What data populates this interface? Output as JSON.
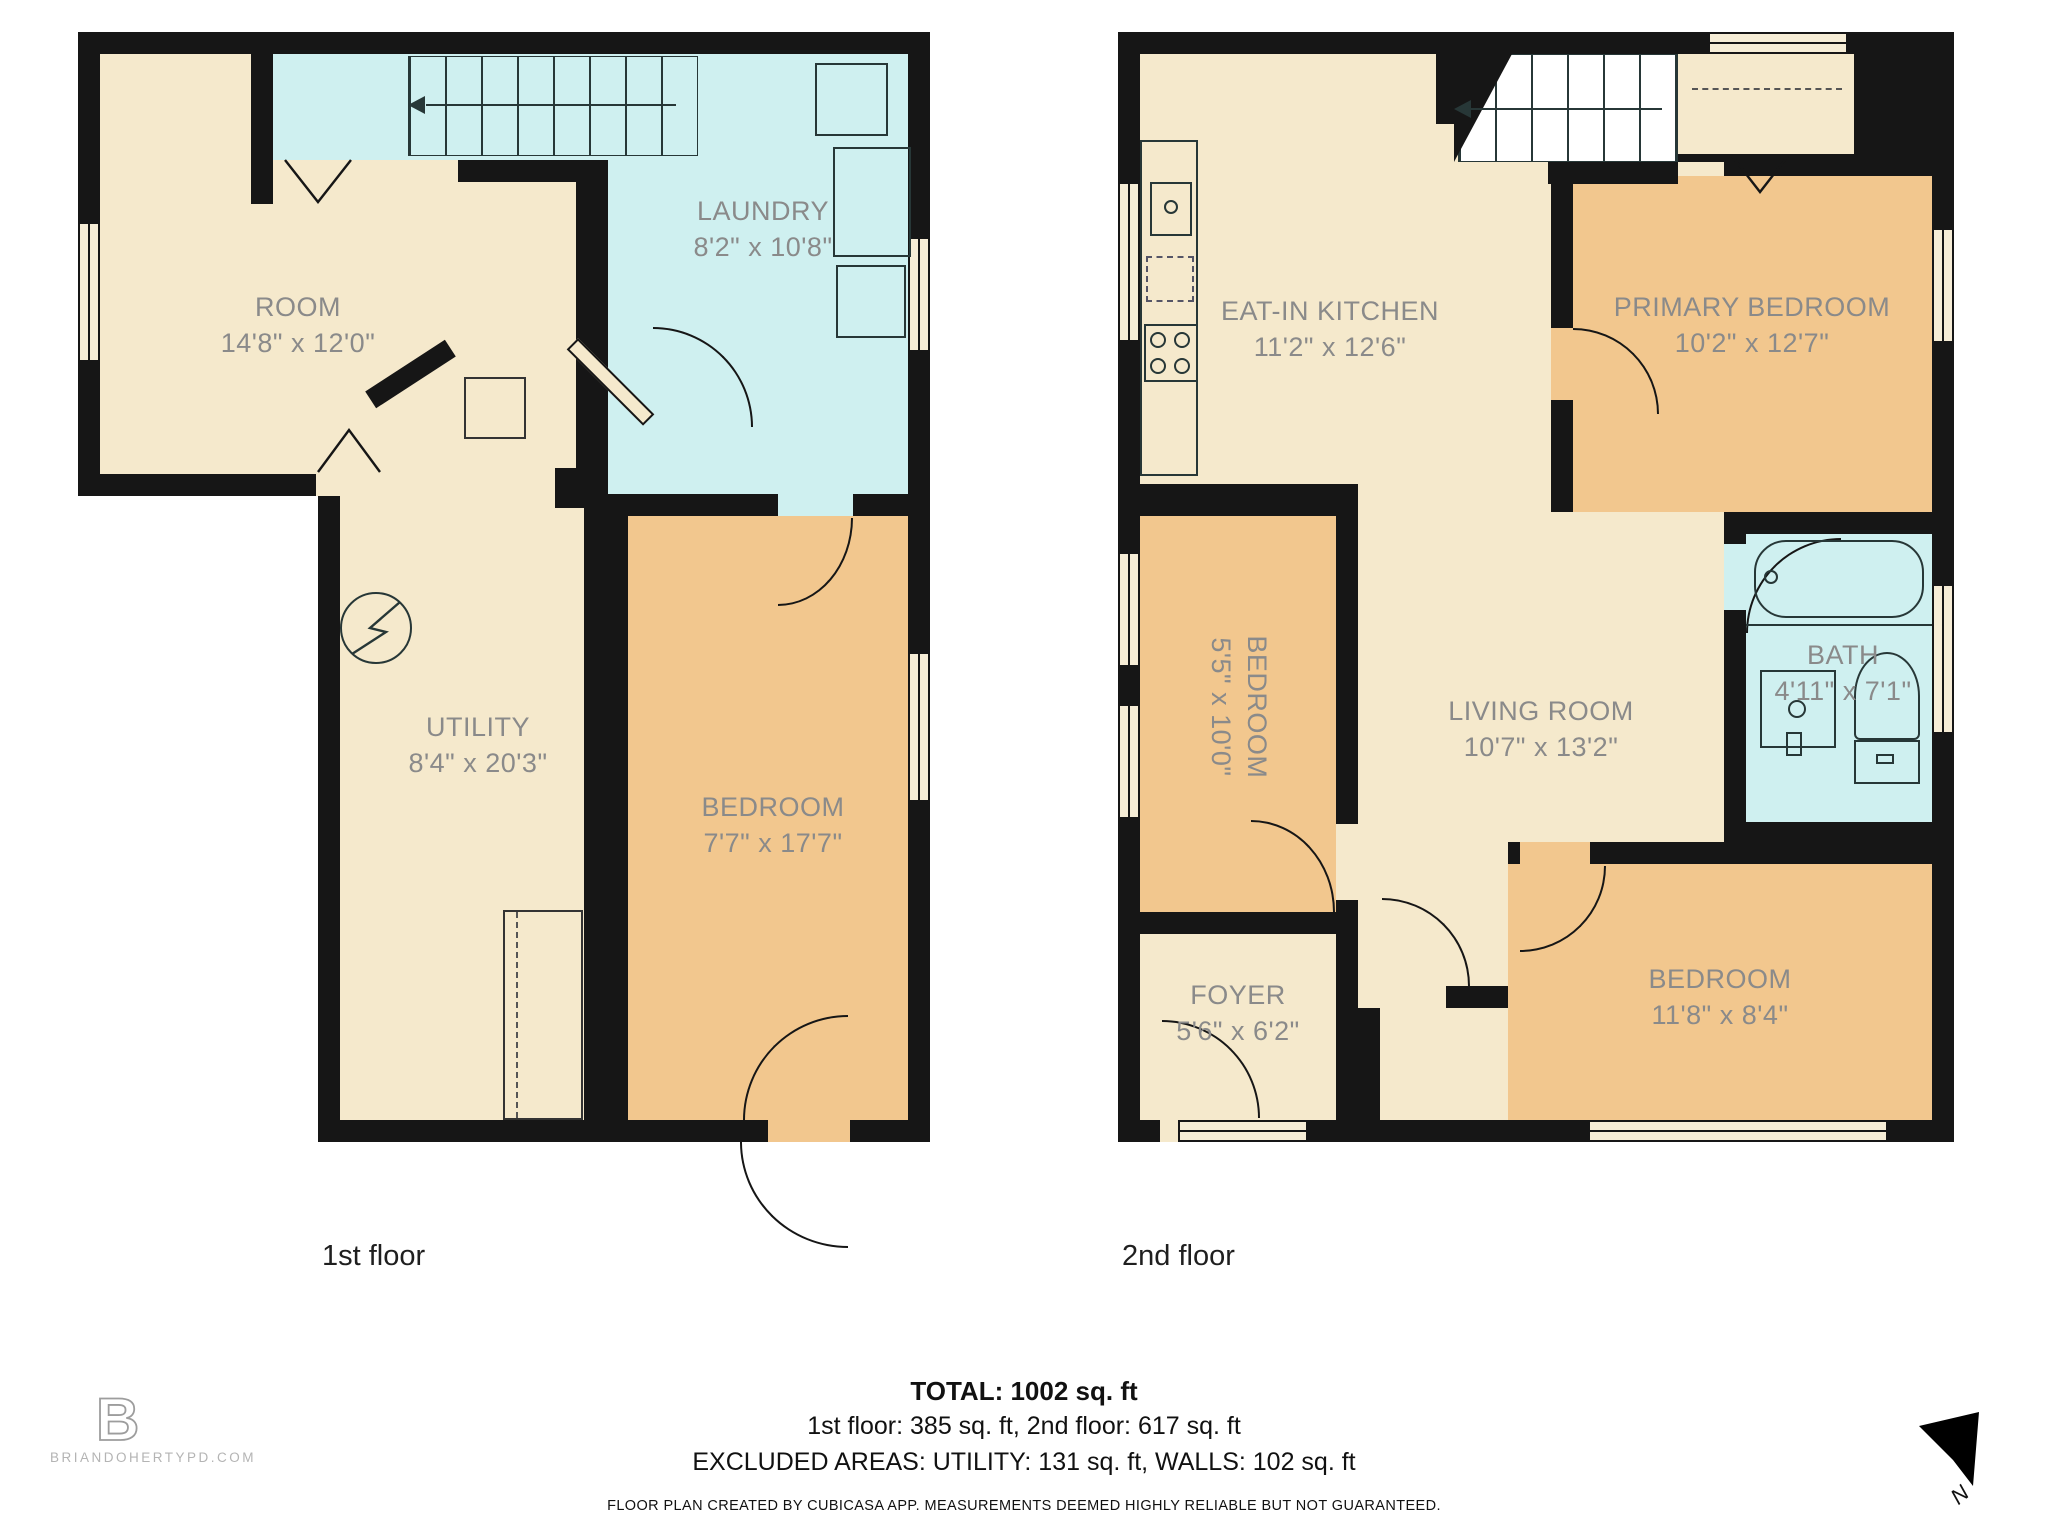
{
  "colors": {
    "wall": "#161616",
    "room_beige": "#F5E9CC",
    "room_orange": "#F2C78E",
    "room_cyan": "#CFF0F0",
    "label_gray": "#8a8a8a"
  },
  "floor1": {
    "caption": "1st floor",
    "rooms": {
      "room": {
        "name": "ROOM",
        "dims": "14'8\" x 12'0\""
      },
      "laundry": {
        "name": "LAUNDRY",
        "dims": "8'2\" x 10'8\""
      },
      "utility": {
        "name": "UTILITY",
        "dims": "8'4\" x 20'3\""
      },
      "bedroom": {
        "name": "BEDROOM",
        "dims": "7'7\" x 17'7\""
      }
    }
  },
  "floor2": {
    "caption": "2nd floor",
    "rooms": {
      "kitchen": {
        "name": "EAT-IN KITCHEN",
        "dims": "11'2\" x 12'6\""
      },
      "primary": {
        "name": "PRIMARY BEDROOM",
        "dims": "10'2\" x 12'7\""
      },
      "bedroom_small": {
        "name": "BEDROOM",
        "dims": "5'5\" x 10'0\""
      },
      "living": {
        "name": "LIVING ROOM",
        "dims": "10'7\" x 13'2\""
      },
      "bath": {
        "name": "BATH",
        "dims": "4'11\" x 7'1\""
      },
      "foyer": {
        "name": "FOYER",
        "dims": "5'6\" x 6'2\""
      },
      "bedroom_rear": {
        "name": "BEDROOM",
        "dims": "11'8\" x 8'4\""
      }
    }
  },
  "summary": {
    "total": "TOTAL: 1002 sq. ft",
    "floor_areas": "1st floor: 385 sq. ft, 2nd floor: 617 sq. ft",
    "excluded": "EXCLUDED AREAS: UTILITY: 131 sq. ft, WALLS: 102 sq. ft",
    "disclaimer": "FLOOR PLAN CREATED BY CUBICASA APP. MEASUREMENTS DEEMED HIGHLY RELIABLE BUT NOT GUARANTEED."
  },
  "branding": {
    "logo_letter": "B",
    "website": "BRIANDOHERTYPD.COM"
  },
  "compass": {
    "north_label": "N"
  }
}
